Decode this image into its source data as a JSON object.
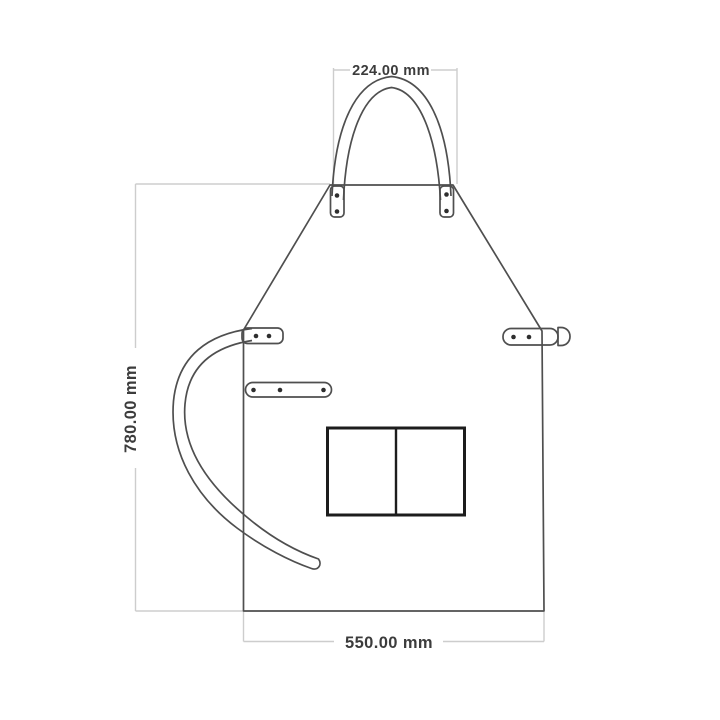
{
  "diagram": {
    "kind": "technical dimension drawing",
    "subject": "apron front view with neck strap, waist ties and double pocket",
    "dimensions": {
      "top": {
        "label": "224.00 mm",
        "value": 224.0,
        "unit": "mm",
        "measures": "neck strap width"
      },
      "left": {
        "label": "780.00 mm",
        "value": 780.0,
        "unit": "mm",
        "measures": "overall height"
      },
      "bottom": {
        "label": "550.00 mm",
        "value": 550.0,
        "unit": "mm",
        "measures": "overall width"
      }
    },
    "colors": {
      "outline": "#4f4f4f",
      "dimension_line": "#cdcdcd",
      "label_text": "#3c3c3c",
      "rivet": "#2e2e2e",
      "pocket": "#1d1d1d",
      "background": "#ffffff"
    },
    "features": {
      "neck_strap_rivets_per_tab": 2,
      "left_shoulder_tab_rivets": 2,
      "left_mid_strap_rivets": 3,
      "right_waist_strap_rivets": 2,
      "pocket_compartments": 2
    }
  }
}
